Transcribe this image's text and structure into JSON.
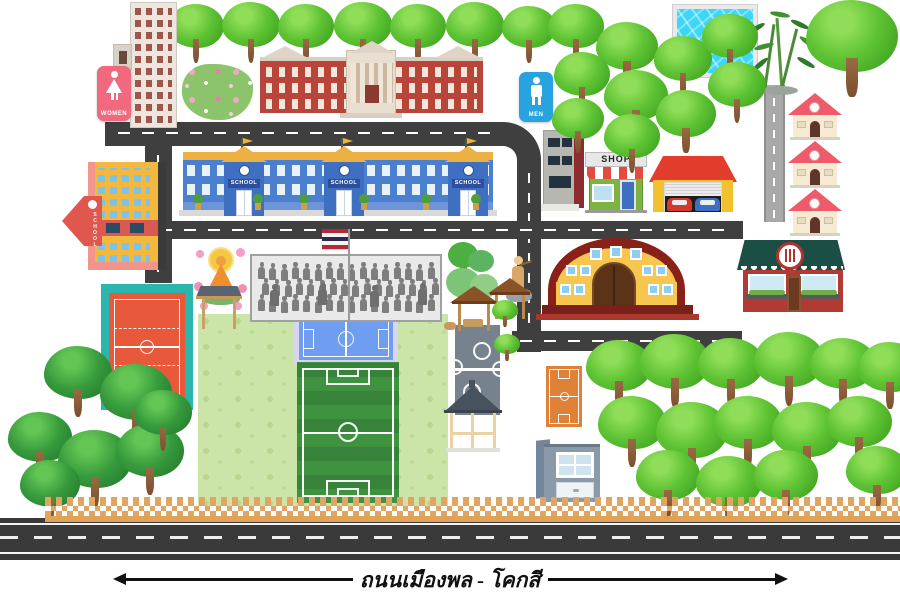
{
  "map": {
    "road_label": "ถนนเมืองพล - โคกสี"
  },
  "signs": {
    "women": "WOMEN",
    "men": "MEN",
    "shop": "SHOP",
    "school": "SCHOOL",
    "school_yellow": "SCHOOL"
  },
  "colors": {
    "road": "#3f3f3f",
    "road_secondary": "#a9a9a9",
    "grass_field": "#cbe4a8",
    "football_green": "#3f9340",
    "futsal_blue": "#6f9df0",
    "volleyball_teal": "#2ab5ad",
    "volleyball_orange": "#e8583a",
    "basketball_orange": "#e08138",
    "takraw_gray": "#76828e",
    "school_blue": "#4b7fd0",
    "school_yellow_wall": "#f3b83d",
    "classic_red": "#b9453a",
    "auditorium_yellow": "#f6c64e",
    "auditorium_roof": "#8a2119",
    "restaurant_red": "#b23a34",
    "restaurant_awning": "#1b4f45",
    "shop_green": "#7cb342",
    "garage_roof": "#e23c2d",
    "garage_wall": "#f2c12e",
    "house_roof": "#ef5b6b",
    "house_wall": "#f7ead2",
    "women_pink": "#f0697e",
    "men_blue": "#29a3e0",
    "pool_water": "#3cd6f7",
    "tree_green": "#54bd2e",
    "fence_tan": "#e2a561",
    "thai_flag": [
      "#b5283b",
      "#f4f5f0",
      "#2d2a4a"
    ]
  },
  "scenery": {
    "trees_top_row": [
      [
        168,
        4,
        56
      ],
      [
        222,
        2,
        58
      ],
      [
        278,
        4,
        56
      ],
      [
        334,
        2,
        58
      ],
      [
        390,
        4,
        56
      ],
      [
        446,
        2,
        58
      ],
      [
        502,
        6,
        54
      ]
    ],
    "trees_top_right": [
      [
        548,
        4,
        56
      ],
      [
        596,
        22,
        62
      ],
      [
        554,
        52,
        56
      ],
      [
        604,
        70,
        64
      ],
      [
        654,
        36,
        58
      ],
      [
        702,
        14,
        56
      ],
      [
        656,
        90,
        60
      ],
      [
        708,
        62,
        58
      ],
      [
        604,
        114,
        56
      ],
      [
        552,
        98,
        52
      ],
      [
        806,
        0,
        92
      ]
    ],
    "trees_bottom_left": [
      [
        44,
        346,
        68
      ],
      [
        100,
        364,
        72
      ],
      [
        8,
        412,
        64
      ],
      [
        58,
        430,
        74
      ],
      [
        116,
        424,
        68
      ],
      [
        20,
        460,
        60
      ],
      [
        134,
        390,
        58
      ]
    ],
    "trees_bottom_right": [
      [
        586,
        340,
        66
      ],
      [
        640,
        334,
        70
      ],
      [
        698,
        338,
        66
      ],
      [
        754,
        332,
        70
      ],
      [
        810,
        338,
        66
      ],
      [
        858,
        342,
        64
      ],
      [
        598,
        396,
        68
      ],
      [
        656,
        402,
        72
      ],
      [
        714,
        396,
        68
      ],
      [
        772,
        402,
        70
      ],
      [
        826,
        396,
        66
      ],
      [
        636,
        450,
        64
      ],
      [
        696,
        456,
        66
      ],
      [
        754,
        450,
        64
      ],
      [
        846,
        446,
        62
      ]
    ],
    "trees_small": [
      [
        492,
        300,
        26
      ],
      [
        494,
        334,
        26
      ]
    ]
  },
  "assembly": {
    "rows": 3,
    "cols": 16,
    "leaders": [
      [
        18,
        34
      ],
      [
        66,
        33
      ],
      [
        118,
        35
      ],
      [
        166,
        33
      ]
    ]
  }
}
